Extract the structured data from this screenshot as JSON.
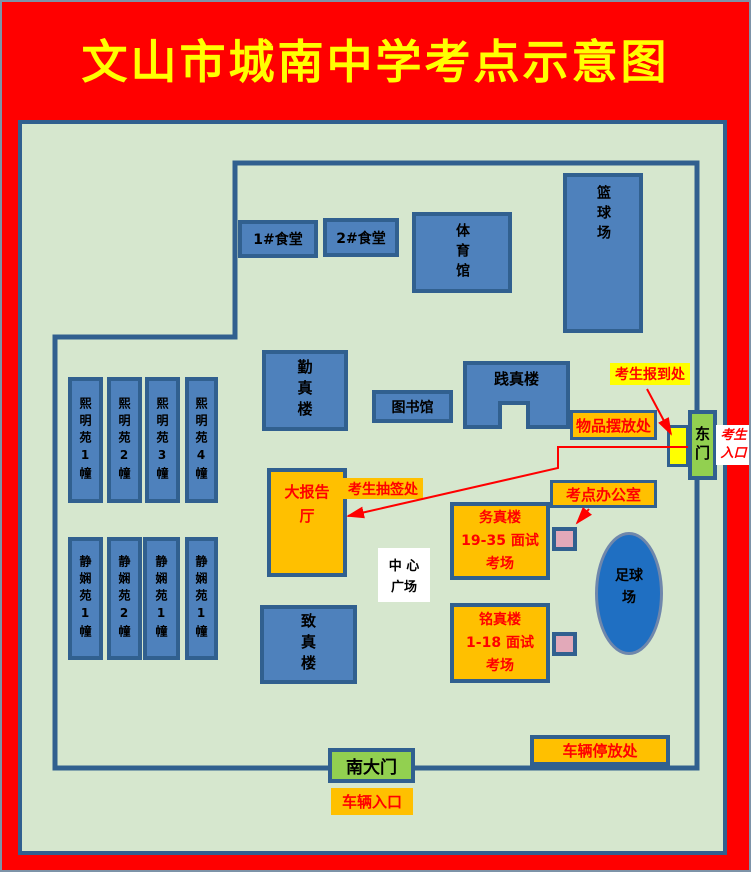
{
  "title": "文山市城南中学考点示意图",
  "palette": {
    "frame_red": "#FF0000",
    "title_yellow": "#FFFF00",
    "campus_green": "#D6E7CE",
    "wall_blue": "#31608F",
    "building_blue": "#4E81BC",
    "accent_orange": "#FFC000",
    "gate_green": "#92D050",
    "highlight_yellow": "#FFFF00",
    "pink": "#E2A9B9",
    "field_blue": "#1F6FC2",
    "label_red": "#FF0000"
  },
  "buildings": {
    "canteen1": {
      "label": "1#食堂"
    },
    "canteen2": {
      "label": "2#食堂"
    },
    "gym": {
      "label": "体育馆"
    },
    "basketball": {
      "label": "篮球场"
    },
    "qinzhen": {
      "label": "勤真楼"
    },
    "library": {
      "label": "图书馆"
    },
    "jianzhen": {
      "label": "践真楼"
    },
    "zhizhen": {
      "label": "致真楼"
    },
    "ximingyuan": [
      {
        "label": "熙明苑1幢"
      },
      {
        "label": "熙明苑2幢"
      },
      {
        "label": "熙明苑3幢"
      },
      {
        "label": "熙明苑4幢"
      }
    ],
    "jingxianyuan": [
      {
        "label": "静娴苑1幢"
      },
      {
        "label": "静娴苑2幢"
      },
      {
        "label": "静娴苑1幢"
      },
      {
        "label": "静娴苑1幢"
      }
    ]
  },
  "exam_sites": {
    "lecture_hall": {
      "lines": [
        "大报告",
        "厅"
      ]
    },
    "wuzhen": {
      "lines": [
        "务真楼",
        "19-35 面试",
        "考场"
      ]
    },
    "mingzhen": {
      "lines": [
        "铭真楼",
        "1-18 面试",
        "考场"
      ]
    },
    "parking": {
      "label": "车辆停放处"
    }
  },
  "labels": {
    "checkin": "考生报到处",
    "items": "物品摆放处",
    "office": "考点办公室",
    "lottery": "考生抽签处",
    "vehicle_entrance": "车辆入口",
    "plaza": {
      "lines": [
        "中 心",
        "广场"
      ]
    },
    "candidate_entrance": {
      "lines": [
        "考生",
        "入口"
      ]
    },
    "football": {
      "lines": [
        "足球",
        "场"
      ]
    }
  },
  "gates": {
    "east": "东门",
    "south": "南大门"
  }
}
